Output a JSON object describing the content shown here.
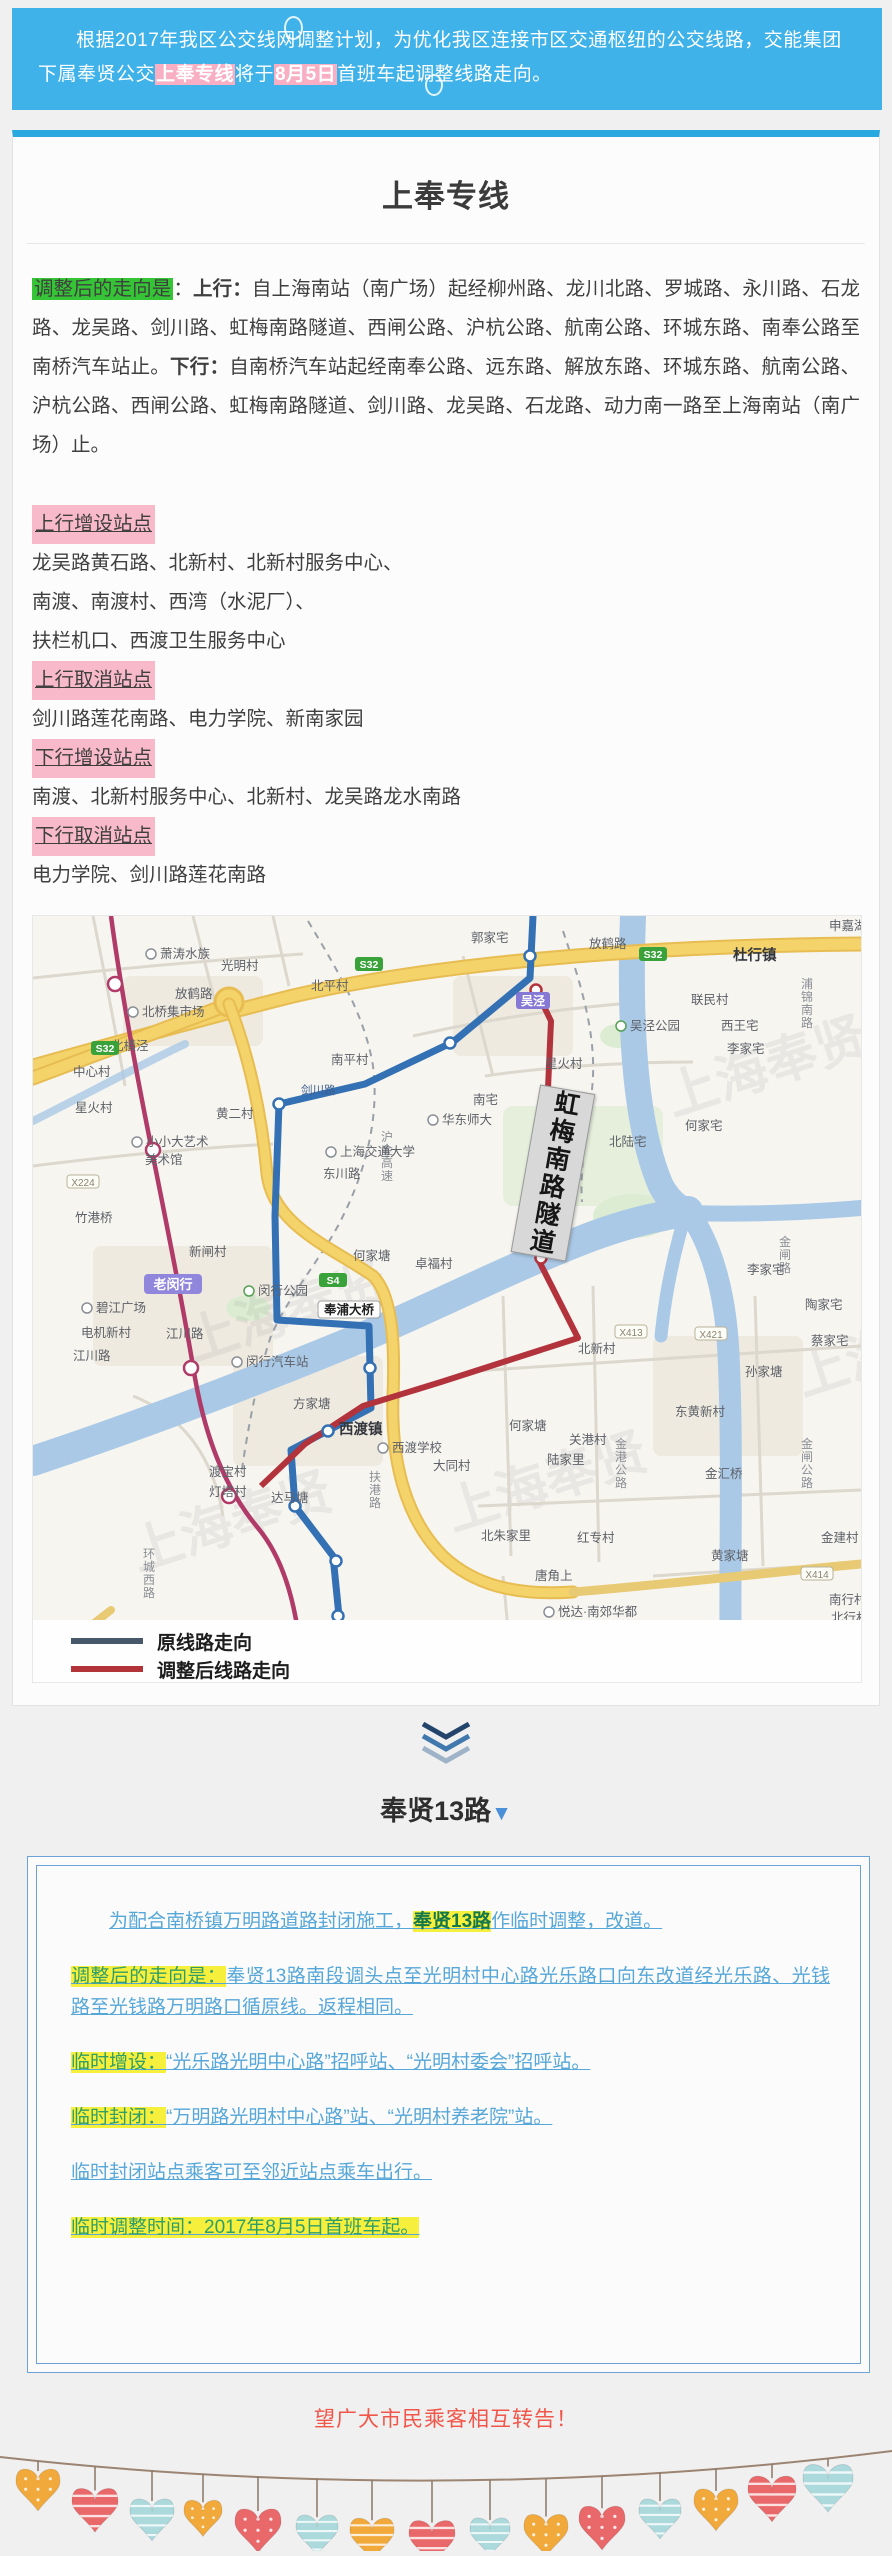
{
  "banner": {
    "part1": "根据2017年我区公交线网调整计划，为优化我区连接市区交通枢纽的公交线路，交能集团下属奉贤公交",
    "hl1": "上奉专线",
    "mid": "将于",
    "hl2": "8月5日",
    "part2": "首班车起调整线路走向。"
  },
  "card1": {
    "title": "上奉专线",
    "route_paragraph": [
      {
        "t": "调整后的走向是",
        "s": "hl-green"
      },
      {
        "t": "：",
        "s": ""
      },
      {
        "t": "上行：",
        "s": "bold"
      },
      {
        "t": "自上海南站（南广场）起经柳州路、龙川北路、罗城路、永川路、石龙路、龙吴路、剑川路、虹梅南路隧道、西闸公路、沪杭公路、航南公路、环城东路、南奉公路至南桥汽车站止。",
        "s": ""
      },
      {
        "t": "下行：",
        "s": "bold"
      },
      {
        "t": "自南桥汽车站起经南奉公路、远东路、解放东路、环城东路、航南公路、沪杭公路、西闸公路、虹梅南路隧道、剑川路、龙吴路、石龙路、动力南一路至上海南站（南广场）止。",
        "s": ""
      }
    ],
    "station_sections": [
      {
        "header": "上行增设站点",
        "lines": [
          "龙吴路黄石路、北新村、北新村服务中心、",
          "南渡、南渡村、西湾（水泥厂）、",
          "扶栏机口、西渡卫生服务中心"
        ]
      },
      {
        "header": "上行取消站点",
        "lines": [
          "剑川路莲花南路、电力学院、新南家园"
        ]
      },
      {
        "header": "下行增设站点",
        "lines": [
          "南渡、北新村服务中心、北新村、龙吴路龙水南路"
        ]
      },
      {
        "header": "下行取消站点",
        "lines": [
          "电力学院、剑川路莲花南路"
        ]
      }
    ]
  },
  "map": {
    "tunnel_label": "虹梅南路隧道",
    "watermark": "上海奉贤",
    "watermarks": [
      {
        "x": 640,
        "y": 200
      },
      {
        "x": 160,
        "y": 445
      },
      {
        "x": 420,
        "y": 615
      },
      {
        "x": 105,
        "y": 655
      },
      {
        "x": 770,
        "y": 480
      }
    ],
    "route_colors": {
      "original": "#3470b4",
      "adjusted": "#b2333c",
      "metro": "#b03a68"
    },
    "legend": [
      {
        "label": "原线路走向",
        "color": "#46586a"
      },
      {
        "label": "调整后线路走向",
        "color": "#b23338"
      }
    ],
    "labels": [
      {
        "t": "萧涛水族",
        "x": 118,
        "y": 42,
        "k": "poi"
      },
      {
        "t": "光明村",
        "x": 188,
        "y": 54,
        "k": "place"
      },
      {
        "t": "放鹤路",
        "x": 142,
        "y": 82,
        "k": "place"
      },
      {
        "t": "北平村",
        "x": 278,
        "y": 74,
        "k": "place"
      },
      {
        "t": "郭家宅",
        "x": 438,
        "y": 26,
        "k": "place"
      },
      {
        "t": "放鹤路",
        "x": 556,
        "y": 32,
        "k": "place"
      },
      {
        "t": "杜行镇",
        "x": 700,
        "y": 44,
        "k": "town"
      },
      {
        "t": "申嘉湖",
        "x": 796,
        "y": 14,
        "k": "place"
      },
      {
        "t": "浦锦南路",
        "x": 768,
        "y": 72,
        "k": "vroad"
      },
      {
        "t": "联民村",
        "x": 658,
        "y": 88,
        "k": "place"
      },
      {
        "t": "西王宅",
        "x": 688,
        "y": 114,
        "k": "place"
      },
      {
        "t": "李家宅",
        "x": 694,
        "y": 137,
        "k": "place"
      },
      {
        "t": "吴泾公园",
        "x": 588,
        "y": 114,
        "k": "poi-green"
      },
      {
        "t": "吴泾",
        "x": 500,
        "y": 89,
        "k": "badge-purple"
      },
      {
        "t": "北桥集市场",
        "x": 100,
        "y": 100,
        "k": "poi"
      },
      {
        "t": "北横泾",
        "x": 78,
        "y": 134,
        "k": "place"
      },
      {
        "t": "中心村",
        "x": 40,
        "y": 160,
        "k": "place"
      },
      {
        "t": "黄二村",
        "x": 183,
        "y": 202,
        "k": "place"
      },
      {
        "t": "南平村",
        "x": 298,
        "y": 148,
        "k": "place"
      },
      {
        "t": "剑川路",
        "x": 268,
        "y": 178,
        "k": "roadlbl"
      },
      {
        "t": "沪金高速",
        "x": 348,
        "y": 225,
        "k": "vroad"
      },
      {
        "t": "上海交通大学",
        "x": 298,
        "y": 240,
        "k": "poi"
      },
      {
        "t": "华东师大",
        "x": 400,
        "y": 208,
        "k": "poi"
      },
      {
        "t": "东川路",
        "x": 290,
        "y": 262,
        "k": "place"
      },
      {
        "t": "星火村",
        "x": 512,
        "y": 152,
        "k": "place"
      },
      {
        "t": "南宅",
        "x": 440,
        "y": 188,
        "k": "place"
      },
      {
        "t": "小小大艺术",
        "x": 104,
        "y": 230,
        "k": "poi"
      },
      {
        "t": "美术馆",
        "x": 112,
        "y": 248,
        "k": "place"
      },
      {
        "t": "竹港桥",
        "x": 42,
        "y": 306,
        "k": "place"
      },
      {
        "t": "新闸村",
        "x": 156,
        "y": 340,
        "k": "place"
      },
      {
        "t": "碧江广场",
        "x": 54,
        "y": 396,
        "k": "poi"
      },
      {
        "t": "电机新村",
        "x": 48,
        "y": 421,
        "k": "place"
      },
      {
        "t": "江川路",
        "x": 40,
        "y": 444,
        "k": "place"
      },
      {
        "t": "江川路",
        "x": 133,
        "y": 422,
        "k": "place"
      },
      {
        "t": "老闵行",
        "x": 140,
        "y": 373,
        "k": "badge-lav"
      },
      {
        "t": "闵行公园",
        "x": 216,
        "y": 379,
        "k": "poi-green"
      },
      {
        "t": "闵行汽车站",
        "x": 204,
        "y": 450,
        "k": "poi"
      },
      {
        "t": "奉浦大桥",
        "x": 316,
        "y": 398,
        "k": "badge-white"
      },
      {
        "t": "方家塘",
        "x": 260,
        "y": 492,
        "k": "place"
      },
      {
        "t": "西渡镇",
        "x": 306,
        "y": 518,
        "k": "town"
      },
      {
        "t": "西渡学校",
        "x": 350,
        "y": 536,
        "k": "poi"
      },
      {
        "t": "渡宝村",
        "x": 176,
        "y": 560,
        "k": "place"
      },
      {
        "t": "灯塔村",
        "x": 176,
        "y": 580,
        "k": "place"
      },
      {
        "t": "达马塘",
        "x": 238,
        "y": 586,
        "k": "place"
      },
      {
        "t": "大同村",
        "x": 400,
        "y": 554,
        "k": "place"
      },
      {
        "t": "扶港路",
        "x": 336,
        "y": 565,
        "k": "vroad"
      },
      {
        "t": "何家塘",
        "x": 320,
        "y": 344,
        "k": "place"
      },
      {
        "t": "卓福村",
        "x": 382,
        "y": 352,
        "k": "place"
      },
      {
        "t": "何家宅",
        "x": 652,
        "y": 214,
        "k": "place"
      },
      {
        "t": "北陆宅",
        "x": 576,
        "y": 230,
        "k": "place"
      },
      {
        "t": "星火村",
        "x": 42,
        "y": 196,
        "k": "place"
      },
      {
        "t": "何家塘",
        "x": 476,
        "y": 514,
        "k": "place"
      },
      {
        "t": "北新村",
        "x": 545,
        "y": 437,
        "k": "place"
      },
      {
        "t": "关港村",
        "x": 536,
        "y": 528,
        "k": "place"
      },
      {
        "t": "陆家里",
        "x": 514,
        "y": 548,
        "k": "place"
      },
      {
        "t": "金港公路",
        "x": 582,
        "y": 532,
        "k": "vroad"
      },
      {
        "t": "东黄新村",
        "x": 642,
        "y": 500,
        "k": "place"
      },
      {
        "t": "孙家塘",
        "x": 712,
        "y": 460,
        "k": "place"
      },
      {
        "t": "陶家宅",
        "x": 772,
        "y": 393,
        "k": "place"
      },
      {
        "t": "蔡家宅",
        "x": 778,
        "y": 429,
        "k": "place"
      },
      {
        "t": "金闸路",
        "x": 746,
        "y": 330,
        "k": "vroad"
      },
      {
        "t": "李家宅",
        "x": 714,
        "y": 358,
        "k": "place"
      },
      {
        "t": "金汇桥",
        "x": 672,
        "y": 562,
        "k": "place"
      },
      {
        "t": "金闸公路",
        "x": 768,
        "y": 532,
        "k": "vroad"
      },
      {
        "t": "北朱家里",
        "x": 448,
        "y": 624,
        "k": "place"
      },
      {
        "t": "红专村",
        "x": 544,
        "y": 626,
        "k": "place"
      },
      {
        "t": "黄家塘",
        "x": 678,
        "y": 644,
        "k": "place"
      },
      {
        "t": "金建村",
        "x": 788,
        "y": 626,
        "k": "place"
      },
      {
        "t": "唐角上",
        "x": 502,
        "y": 664,
        "k": "place"
      },
      {
        "t": "悦达·南郊华都",
        "x": 516,
        "y": 700,
        "k": "poi"
      },
      {
        "t": "南行村",
        "x": 796,
        "y": 688,
        "k": "place"
      },
      {
        "t": "北行村",
        "x": 798,
        "y": 706,
        "k": "place"
      },
      {
        "t": "环城西路",
        "x": 110,
        "y": 642,
        "k": "vroad"
      },
      {
        "t": "S32",
        "x": 336,
        "y": 52,
        "k": "badge-green"
      },
      {
        "t": "S32",
        "x": 72,
        "y": 136,
        "k": "badge-green"
      },
      {
        "t": "S32",
        "x": 620,
        "y": 42,
        "k": "badge-green"
      },
      {
        "t": "S4",
        "x": 300,
        "y": 368,
        "k": "badge-green"
      },
      {
        "t": "X224",
        "x": 50,
        "y": 270,
        "k": "badge-road"
      },
      {
        "t": "X413",
        "x": 598,
        "y": 420,
        "k": "badge-road"
      },
      {
        "t": "X421",
        "x": 678,
        "y": 422,
        "k": "badge-road"
      },
      {
        "t": "X414",
        "x": 784,
        "y": 662,
        "k": "badge-road"
      }
    ]
  },
  "section2": {
    "title": "奉贤13路",
    "arrow": "▼"
  },
  "box": {
    "paragraphs": [
      {
        "indent": true,
        "segs": [
          {
            "t": "为配合南桥镇万明路道路封闭施工，",
            "s": ""
          },
          {
            "t": "奉贤13路",
            "s": "hl-bold"
          },
          {
            "t": "作临时调整，改道。",
            "s": ""
          }
        ]
      },
      {
        "segs": [
          {
            "t": "调整后的走向是：",
            "s": "hl-label"
          },
          {
            "t": "奉贤13路南段调头点至光明村中心路光乐路口向东改道经光乐路、光钱路至光钱路万明路口循原线。返程相同。",
            "s": ""
          }
        ]
      },
      {
        "segs": [
          {
            "t": "临时增设：",
            "s": "hl-label"
          },
          {
            "t": "“光乐路光明中心路”招呼站、“光明村委会”招呼站。",
            "s": ""
          }
        ]
      },
      {
        "segs": [
          {
            "t": "临时封闭：",
            "s": "hl-label"
          },
          {
            "t": "“万明路光明村中心路”站、“光明村养老院”站。",
            "s": ""
          }
        ]
      },
      {
        "segs": [
          {
            "t": "临时封闭站点乘客可至邻近站点乘车出行。",
            "s": ""
          }
        ]
      },
      {
        "segs": [
          {
            "t": "临时调整时间：2017年8月5日首班车起。",
            "s": "hl-label"
          }
        ]
      }
    ]
  },
  "footer": {
    "notice": "望广大市民乘客相互转告！",
    "heart_colors": {
      "orange": "#f2a93b",
      "red": "#e9686a",
      "blue": "#abd9dc"
    },
    "hearts": [
      {
        "x": 38,
        "c": "orange",
        "d": 8,
        "s": 44,
        "p": "dot"
      },
      {
        "x": 95,
        "c": "red",
        "d": 22,
        "s": 46,
        "p": "stripe"
      },
      {
        "x": 152,
        "c": "blue",
        "d": 28,
        "s": 44,
        "p": "stripe"
      },
      {
        "x": 203,
        "c": "orange",
        "d": 26,
        "s": 38,
        "p": "dot"
      },
      {
        "x": 258,
        "c": "red",
        "d": 32,
        "s": 46,
        "p": "dot"
      },
      {
        "x": 317,
        "c": "blue",
        "d": 36,
        "s": 42,
        "p": "stripe"
      },
      {
        "x": 372,
        "c": "orange",
        "d": 38,
        "s": 44,
        "p": "stripe"
      },
      {
        "x": 432,
        "c": "red",
        "d": 40,
        "s": 46,
        "p": "stripe"
      },
      {
        "x": 490,
        "c": "blue",
        "d": 38,
        "s": 40,
        "p": "stripe"
      },
      {
        "x": 546,
        "c": "orange",
        "d": 36,
        "s": 44,
        "p": "dot"
      },
      {
        "x": 602,
        "c": "red",
        "d": 30,
        "s": 46,
        "p": "dot"
      },
      {
        "x": 660,
        "c": "blue",
        "d": 26,
        "s": 42,
        "p": "stripe"
      },
      {
        "x": 716,
        "c": "orange",
        "d": 20,
        "s": 44,
        "p": "dot"
      },
      {
        "x": 772,
        "c": "red",
        "d": 12,
        "s": 48,
        "p": "stripe"
      },
      {
        "x": 828,
        "c": "blue",
        "d": 6,
        "s": 50,
        "p": "stripe"
      }
    ]
  }
}
